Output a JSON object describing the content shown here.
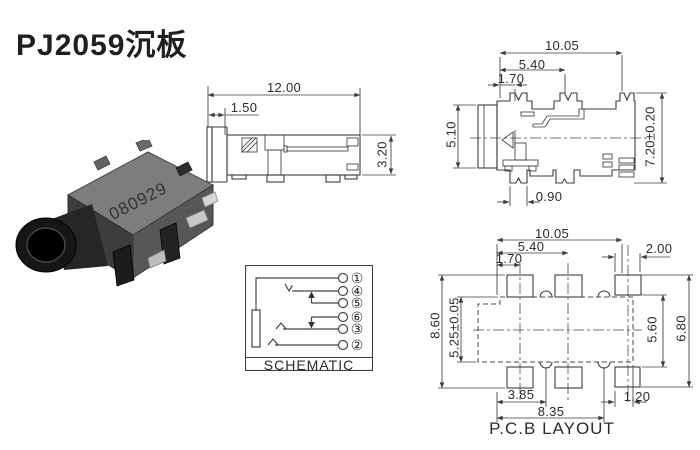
{
  "title": "PJ2059沉板",
  "photo": {
    "stamp": "080929"
  },
  "side_view": {
    "dim_overall_width": "12.00",
    "dim_flange": "1.50",
    "dim_height": "3.20"
  },
  "top_view": {
    "dim_overall_width": "10.05",
    "dim_pin_pitch": "5.40",
    "dim_pin_offset": "1.70",
    "dim_barrel_height": "5.10",
    "dim_overall_depth": "7.20±0.20",
    "dim_pin_width": "0.90"
  },
  "schematic": {
    "label": "SCHEMATIC",
    "pins": [
      "①",
      "④",
      "⑤",
      "⑥",
      "③",
      "②"
    ]
  },
  "pcb_layout": {
    "label": "P.C.B LAYOUT",
    "dim_overall_width": "10.05",
    "dim_pad_pitch": "5.40",
    "dim_pad_offset": "1.70",
    "dim_pad_width": "2.00",
    "dim_outer_height": "8.60",
    "dim_body_height": "5.25±0.05",
    "dim_inner_height": "5.60",
    "dim_right_height": "6.80",
    "dim_bottom_left": "3.85",
    "dim_bottom_span": "8.35",
    "dim_pad_small": "1.20"
  },
  "colors": {
    "line": "#3d3d3d",
    "text": "#2b2b2b",
    "photo_body": "#575757"
  }
}
